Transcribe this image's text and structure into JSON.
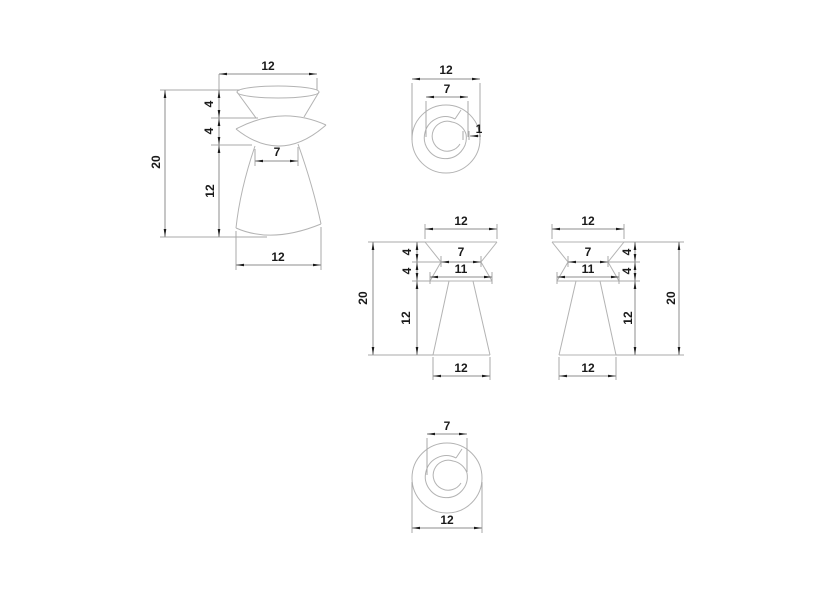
{
  "palette": {
    "background": "#ffffff",
    "geometry_line": "#b3b3b3",
    "dimension_line": "#8c8c8c",
    "text": "#1a1a1a"
  },
  "views": {
    "perspective": {
      "dims": {
        "top_diameter": "12",
        "upper_height": "4",
        "bulge_height": "4",
        "total_height": "20",
        "waist_diameter": "7",
        "lower_height": "12",
        "base_diameter": "12"
      }
    },
    "top": {
      "dims": {
        "outer_diameter": "12",
        "inner_diameter": "7",
        "spiral_step": "1"
      }
    },
    "front": {
      "dims": {
        "top_width": "12",
        "waist_width": "7",
        "bulge_width": "11",
        "upper_height": "4",
        "bulge_height": "4",
        "lower_height": "12",
        "total_height": "20",
        "base_width": "12"
      }
    },
    "side": {
      "dims": {
        "top_width": "12",
        "waist_width": "7",
        "bulge_width": "11",
        "upper_height": "4",
        "bulge_height": "4",
        "lower_height": "12",
        "total_height": "20",
        "base_width": "12"
      }
    },
    "bottom": {
      "dims": {
        "inner_diameter": "7",
        "outer_diameter": "12"
      }
    }
  }
}
